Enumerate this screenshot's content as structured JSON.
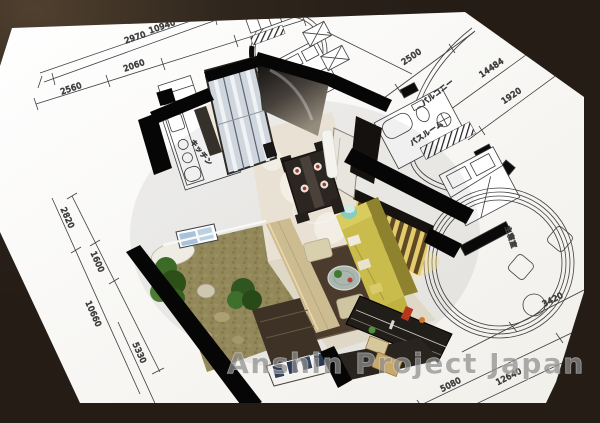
{
  "image": {
    "description": "3D cutaway apartment render placed over an architectural blueprint sheet"
  },
  "watermark": {
    "text": "Anshin Project Japan"
  },
  "blueprint": {
    "room_labels": {
      "kitchen": "キッチン",
      "balcony": "バルコニー",
      "bathroom": "バスルーム",
      "master_bedroom": "主寝室"
    },
    "dimensions": {
      "top": {
        "overall": "10940",
        "mid": "2970",
        "seg1": "2560",
        "seg2": "2060"
      },
      "left": {
        "seg1": "2820",
        "seg2": "1600",
        "overall": "10660",
        "inner": "5330"
      },
      "right": {
        "seg1": "2500",
        "overall": "14484",
        "seg2": "1920"
      },
      "bottom": {
        "seg1": "5080",
        "overall": "12640",
        "seg2": "3420"
      }
    },
    "colors": {
      "background": "#2b211b",
      "paper": "#fbfaf8",
      "line": "#3f3f3f",
      "watermark": "#8e8e8e"
    }
  }
}
